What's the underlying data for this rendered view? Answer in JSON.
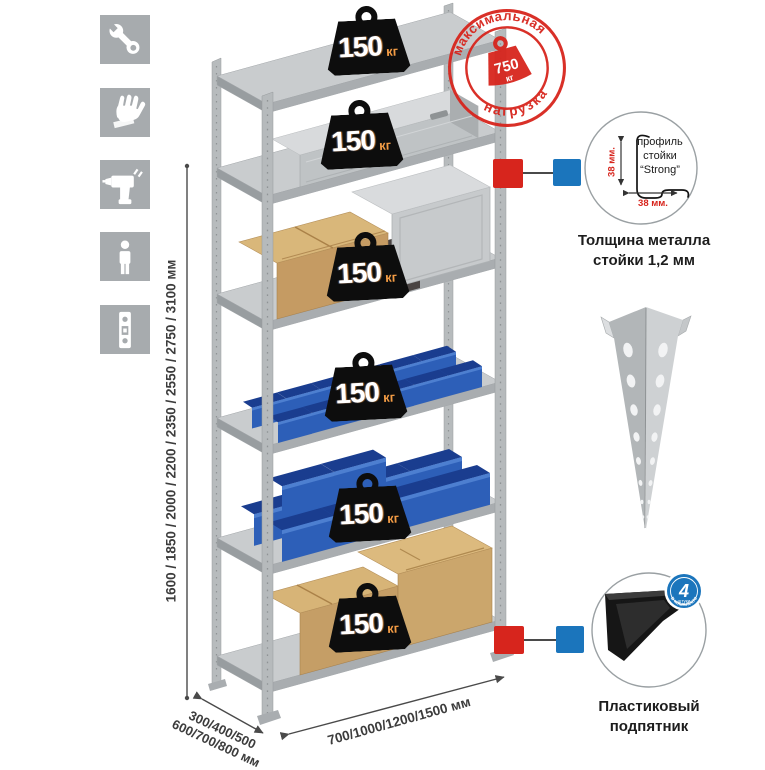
{
  "left_toolbar": {
    "icons": [
      "wrench",
      "gloves",
      "drill",
      "person",
      "level-strip"
    ]
  },
  "rack": {
    "weights": [
      {
        "value": "150",
        "unit": "кг"
      },
      {
        "value": "150",
        "unit": "кг"
      },
      {
        "value": "150",
        "unit": "кг"
      },
      {
        "value": "150",
        "unit": "кг"
      },
      {
        "value": "150",
        "unit": "кг"
      },
      {
        "value": "150",
        "unit": "кг"
      }
    ]
  },
  "stamp": {
    "arc_top": "максимальная",
    "arc_bottom": "нагрузка",
    "value": "750",
    "unit": "кг"
  },
  "dimensions": {
    "height": "1600 / 1850 / 2000 / 2200 / 2350 / 2550 / 2750 / 3100 мм",
    "depth_line1": "300/400/500",
    "depth_line2": "600/700/800 мм",
    "width": "700/1000/1200/1500 мм"
  },
  "profile_detail": {
    "label_line1": "профиль",
    "label_line2": "стойки",
    "label_line3": "“Strong”",
    "height_dim": "38 мм.",
    "width_dim": "38 мм.",
    "caption_line1": "Толщина металла",
    "caption_line2": "стойки 1,2 мм"
  },
  "foot_detail": {
    "badge_count": "4",
    "badge_sub": "штуки",
    "badge_label": "в комплекте",
    "caption_line1": "Пластиковый",
    "caption_line2": "подпятник"
  },
  "colors": {
    "accent_red": "#d7251d",
    "accent_blue": "#1b75bc",
    "bin_blue": "#2d5fb8",
    "icon_bg": "#a7abae"
  }
}
